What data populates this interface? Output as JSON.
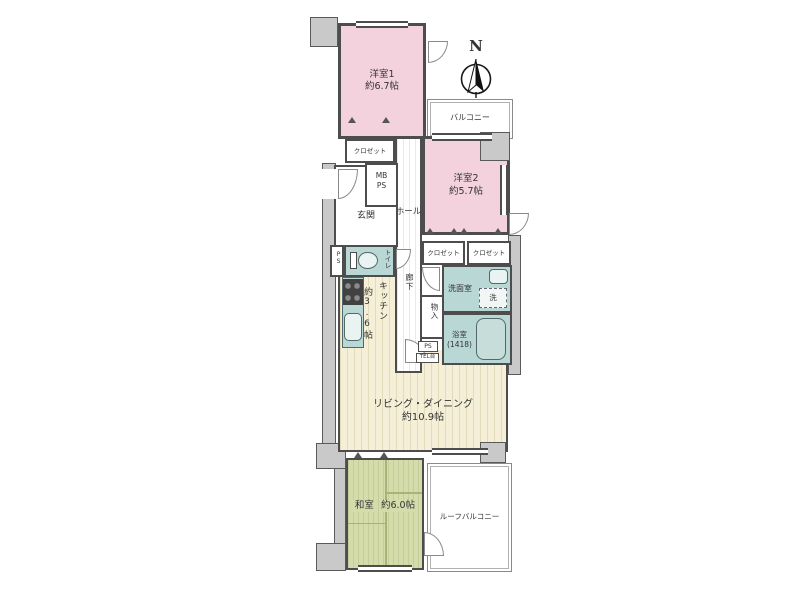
{
  "colors": {
    "wall": "#4d4d4d",
    "room_pink": "#f3d2de",
    "wet_area_teal": "#b9d8d5",
    "flooring_cream": "#f4efd6",
    "tatami_green": "#d5dcab",
    "pillar_gray": "#c9c9c9"
  },
  "compass": {
    "north_label": "N"
  },
  "rooms": {
    "western1": {
      "name": "洋室1",
      "area": "約6.7帖"
    },
    "western2": {
      "name": "洋室2",
      "area": "約5.7帖"
    },
    "living_dining": {
      "name": "リビング・ダイニング",
      "area": "約10.9帖"
    },
    "kitchen": {
      "name": "キッチン",
      "area": "約3.6帖"
    },
    "japanese_room": {
      "name": "和室",
      "area": "約6.0帖"
    },
    "bathroom": {
      "name": "浴室",
      "size": "(1418)"
    },
    "washroom": {
      "name": "洗面室"
    },
    "toilet": {
      "name": "トイレ"
    },
    "entrance": {
      "name": "玄関"
    },
    "hall": {
      "name": "ホール"
    },
    "corridor": {
      "name": "廊下"
    },
    "balcony": {
      "name": "バルコニー"
    },
    "roof_balcony": {
      "name": "ルーフバルコニー"
    }
  },
  "fixtures": {
    "closet1": "クロゼット",
    "closet2": "クロゼット",
    "closet3": "クロゼット",
    "storage": "物入",
    "mb": "MB",
    "ps": "PS",
    "ps_left": "PS",
    "ps_lower": "PS",
    "tel_stand": "TEL台",
    "washer": "洗"
  }
}
